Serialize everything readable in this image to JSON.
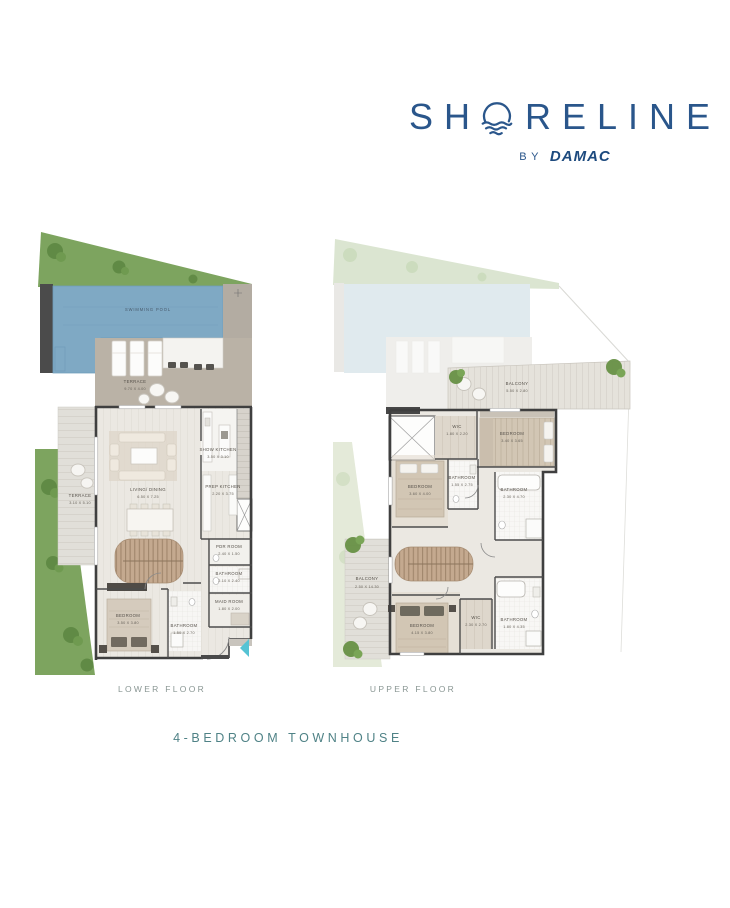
{
  "logo": {
    "name_start": "SH",
    "name_end": "RELINE",
    "sun_icon": "sun-over-waves",
    "by_label": "BY",
    "brand": "DAMAC"
  },
  "title": "4-BEDROOM TOWNHOUSE",
  "captions": {
    "lower": "LOWER FLOOR",
    "upper": "UPPER FLOOR"
  },
  "palette": {
    "logo_navy": "#2a568b",
    "brand_navy": "#1d4a7e",
    "title_teal": "#4f8286",
    "caption_gray": "#899693",
    "grass_green": "#7da45f",
    "pool_blue": "#7fa9c4",
    "terrace_tan": "#bab2a6",
    "stair_wood": "#c4a98f",
    "wall_dark": "#3f3f3f",
    "entry_arrow_teal": "#55c3d4"
  },
  "lower_floor": {
    "rooms": {
      "swimming_pool": {
        "name": "SWIMMING POOL",
        "dims": ""
      },
      "terrace_main": {
        "name": "TERRACE",
        "dims": "9.70 X 4.00"
      },
      "terrace_side": {
        "name": "TERRACE",
        "dims": "3.10 X 5.10"
      },
      "show_kitchen": {
        "name": "SHOW KITCHEN",
        "dims": "3.50 X 3.10"
      },
      "living_dining": {
        "name": "LIVING/ DINING",
        "dims": "6.50 X 7.25"
      },
      "prep_kitchen": {
        "name": "PREP KITCHEN",
        "dims": "2.20 X 3.75"
      },
      "pdr_room": {
        "name": "PDR ROOM",
        "dims": "2.40 X 1.50"
      },
      "bathroom": {
        "name": "BATHROOM",
        "dims": "2.10 X 2.40"
      },
      "maid_room": {
        "name": "MAID ROOM",
        "dims": "1.80 X 2.00"
      },
      "bedroom": {
        "name": "BEDROOM",
        "dims": "3.50 X 3.80"
      },
      "bedroom_bathroom": {
        "name": "BATHROOM",
        "dims": "1.50 X 2.70"
      }
    }
  },
  "upper_floor": {
    "rooms": {
      "balcony_rear": {
        "name": "BALCONY",
        "dims": "5.50 X 2.80"
      },
      "wic_top": {
        "name": "WIC",
        "dims": "1.80 X 2.20"
      },
      "bedroom_top": {
        "name": "BEDROOM",
        "dims": "3.40 X 3.65"
      },
      "bathroom_mid": {
        "name": "BATHROOM",
        "dims": "1.55 X 2.75"
      },
      "bedroom_mid": {
        "name": "BEDROOM",
        "dims": "3.60 X 4.00"
      },
      "bathroom_right": {
        "name": "BATHROOM",
        "dims": "2.30 X 4.70"
      },
      "balcony_front": {
        "name": "BALCONY",
        "dims": "2.50 X 14.30"
      },
      "bedroom_master": {
        "name": "BEDROOM",
        "dims": "4.15 X 3.80"
      },
      "wic_master": {
        "name": "WIC",
        "dims": "2.30 X 2.70"
      },
      "bathroom_master": {
        "name": "BATHROOM",
        "dims": "1.80 X 4.35"
      }
    }
  }
}
